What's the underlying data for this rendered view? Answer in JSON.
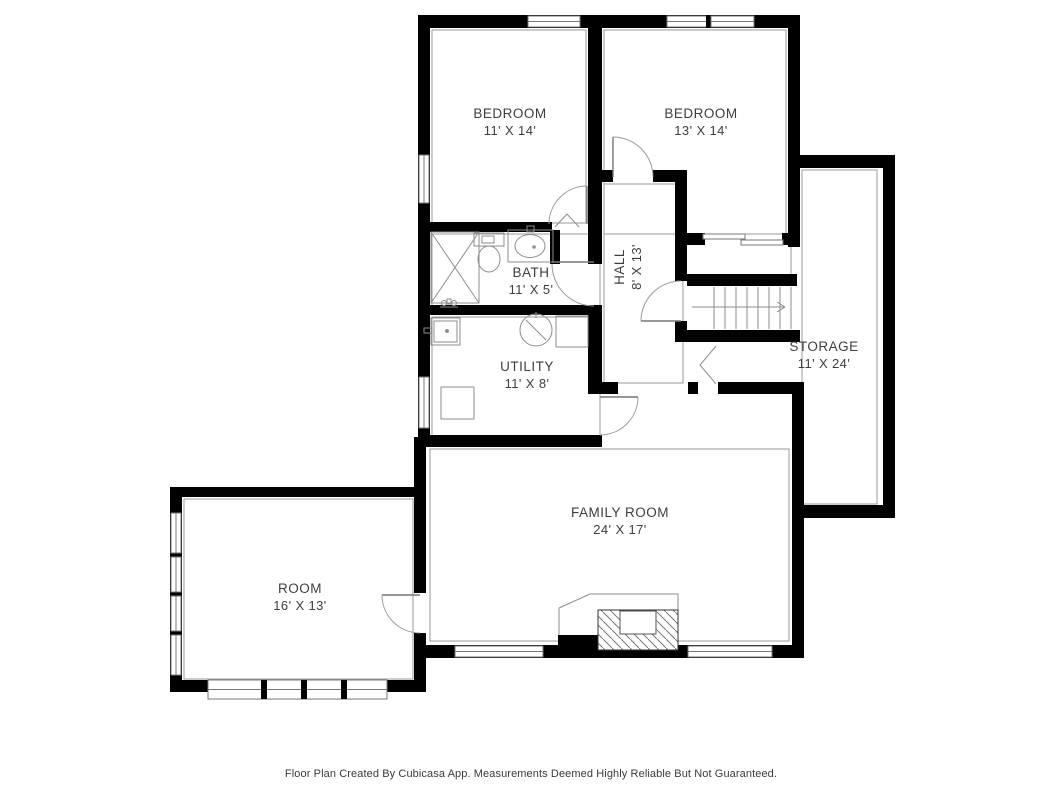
{
  "colors": {
    "background": "#ffffff",
    "wall": "#000000",
    "fixture_line": "#8d8d8d",
    "text": "#3e3e3e"
  },
  "rooms": {
    "bedroom1": {
      "name": "BEDROOM",
      "dims": "11' X 14'"
    },
    "bedroom2": {
      "name": "BEDROOM",
      "dims": "13' X 14'"
    },
    "bath": {
      "name": "BATH",
      "dims": "11' X 5'"
    },
    "hall": {
      "name": "HALL",
      "dims": "8' X 13'"
    },
    "utility": {
      "name": "UTILITY",
      "dims": "11' X 8'"
    },
    "storage": {
      "name": "STORAGE",
      "dims": "11' X 24'"
    },
    "family_room": {
      "name": "FAMILY ROOM",
      "dims": "24' X 17'"
    },
    "room": {
      "name": "ROOM",
      "dims": "16' X 13'"
    }
  },
  "fixtures": [
    "shower-icon",
    "toilet-icon",
    "sink-icon",
    "laundry-sink-icon",
    "water-heater-icon",
    "dryer-icon",
    "washer-icon",
    "fireplace-icon",
    "stairs-icon",
    "stairs-direction-arrow"
  ],
  "footer": {
    "text": "Floor Plan Created By Cubicasa App. Measurements Deemed Highly Reliable But Not Guaranteed."
  }
}
